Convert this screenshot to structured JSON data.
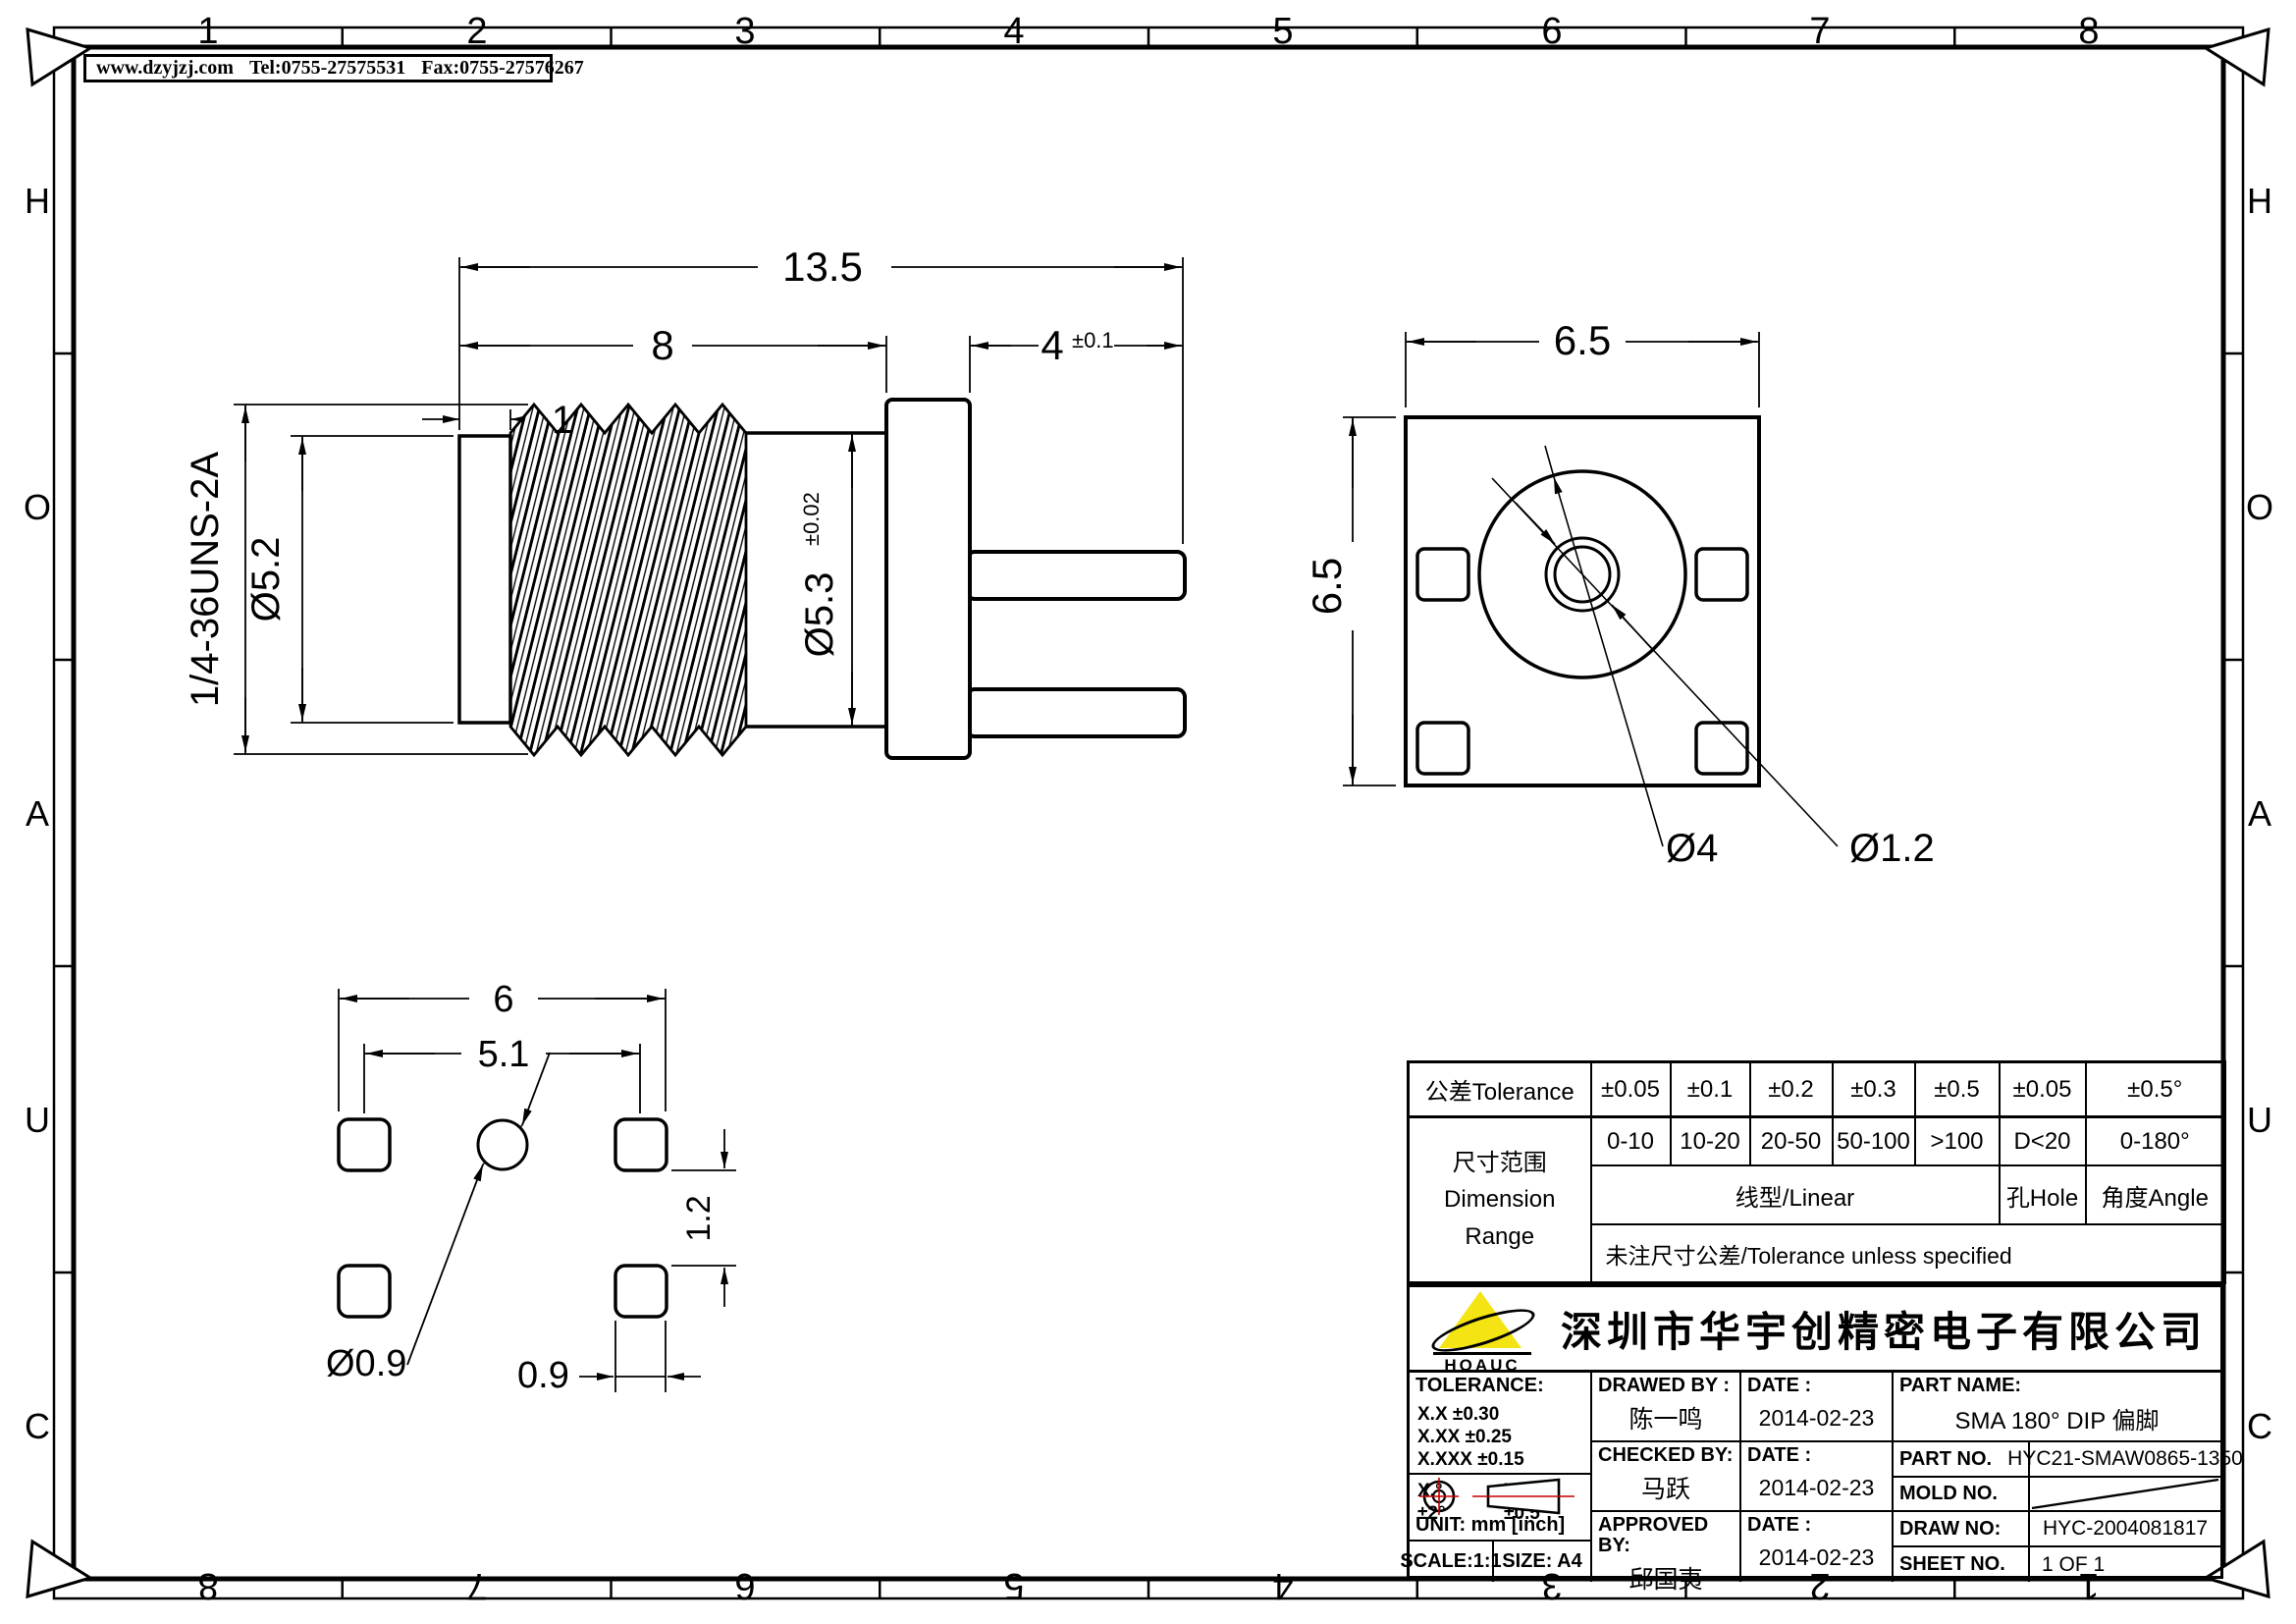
{
  "header": {
    "website": "www.dzyjzj.com",
    "tel": "Tel:0755-27575531",
    "fax": "Fax:0755-27576267"
  },
  "zones": {
    "cols": [
      "1",
      "2",
      "3",
      "4",
      "5",
      "6",
      "7",
      "8"
    ],
    "rows": [
      "H",
      "O",
      "A",
      "U",
      "C"
    ]
  },
  "side_view": {
    "len_total": "13.5",
    "len_thread": "8",
    "len_cap": "1",
    "len_tail": "4",
    "len_tail_tol": "±0.1",
    "thread_spec": "1/4-36UNS-2A",
    "dia_cap": "Ø5.2",
    "dia_barrel": "Ø5.3",
    "dia_barrel_tol": "±0.02"
  },
  "front_view": {
    "width": "6.5",
    "height": "6.5",
    "dia_flange": "Ø4",
    "dia_pin": "Ø1.2"
  },
  "footprint": {
    "pitch_outer": "6",
    "pitch": "5.1",
    "offset": "1.2",
    "dia_hole": "Ø0.9",
    "pad_size": "0.9"
  },
  "tol_table": {
    "header_label": "公差Tolerance",
    "tols": [
      "±0.05",
      "±0.1",
      "±0.2",
      "±0.3",
      "±0.5",
      "±0.05",
      "±0.5°"
    ],
    "ranges": [
      "0-10",
      "10-20",
      "20-50",
      "50-100",
      ">100",
      "D<20",
      "0-180°"
    ],
    "range_label_cn": "尺寸范围",
    "range_label_en1": "Dimension",
    "range_label_en2": "Range",
    "linear_label": "线型/Linear",
    "hole_label": "孔Hole",
    "angle_label": "角度Angle",
    "note": "未注尺寸公差/Tolerance unless specified"
  },
  "title_block": {
    "company": "深圳市华宇创精密电子有限公司",
    "logo_text": "HOAUC",
    "tolerance_label": "TOLERANCE:",
    "tol_line1": "X.X    ±0.30",
    "tol_line2": "X.XX   ±0.25",
    "tol_line3": "X.XXX  ±0.15",
    "tol_deg1": "X.°  ±2°",
    "tol_deg2": "X.X°  ±0.5°",
    "unit_label": "UNIT:  mm  [inch]",
    "scale_label": "SCALE:1:1",
    "size_label": "SIZE:  A4",
    "drawed_by_label": "DRAWED BY :",
    "drawed_by": "陈一鸣",
    "checked_by_label": "CHECKED BY:",
    "checked_by": "马跃",
    "approved_by_label": "APPROVED BY:",
    "approved_by": "邱国夷",
    "date_label": "DATE :",
    "date_drawed": "2014-02-23",
    "date_checked": "2014-02-23",
    "date_approved": "2014-02-23",
    "part_name_label": "PART NAME:",
    "part_name": "SMA 180° DIP 偏脚",
    "part_no_label": "PART NO.",
    "part_no": "HYC21-SMAW0865-1350",
    "mold_no_label": "MOLD NO.",
    "draw_no_label": "DRAW NO:",
    "draw_no": "HYC-2004081817",
    "sheet_no_label": "SHEET NO.",
    "sheet_no": "1 OF 1"
  }
}
